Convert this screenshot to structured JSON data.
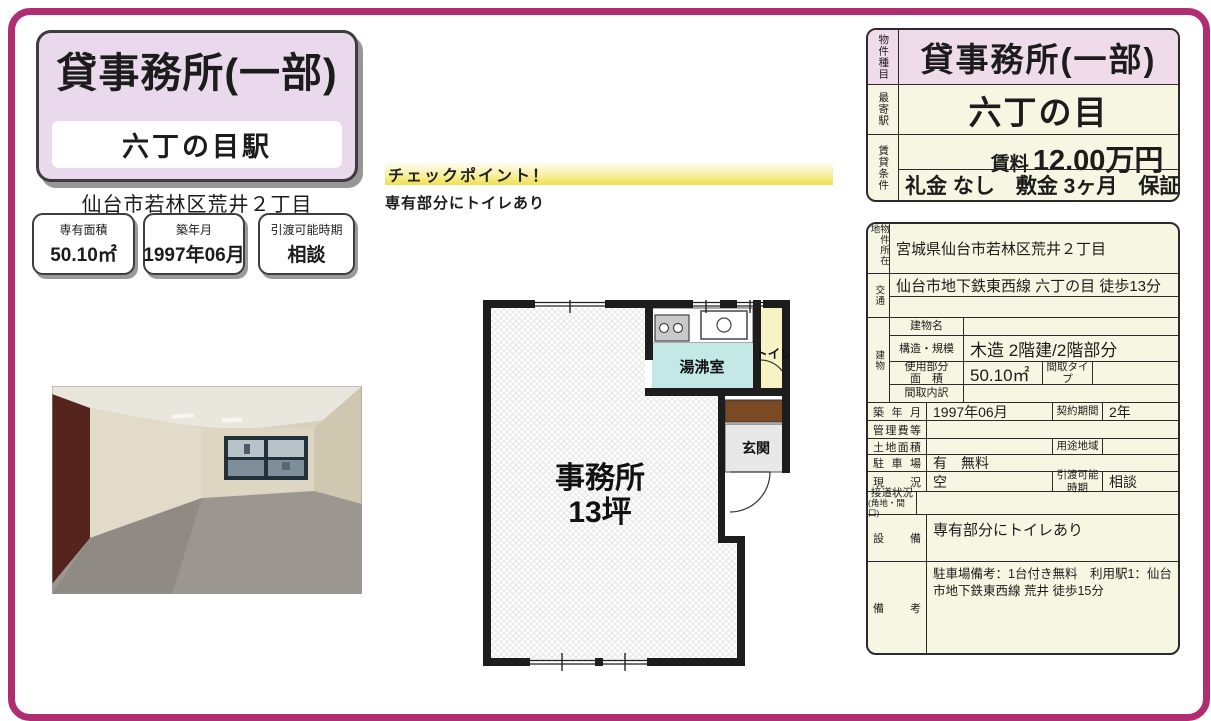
{
  "colors": {
    "frame": "#b02d72",
    "title_bg": "#ead9ec",
    "table_bg": "#f6f6e2",
    "pink_row": "#f0dbea",
    "checkpoint_yellow": "#efe14e",
    "kitchen_teal": "#c3e8e5",
    "toilet_yellow": "#f8f3c5",
    "entrance_brown": "#7a4a24"
  },
  "header": {
    "title": "貸事務所(一部)",
    "station": "六丁の目駅",
    "address": "仙台市若林区荒井２丁目"
  },
  "info_boxes": [
    {
      "label": "専有面積",
      "value": "50.10㎡"
    },
    {
      "label": "築年月",
      "value": "1997年06月"
    },
    {
      "label": "引渡可能時期",
      "value": "相談"
    }
  ],
  "checkpoint": {
    "title": "チェックポイント！",
    "text": "専有部分にトイレあり"
  },
  "floorplan": {
    "office": "事務所",
    "office_size": "13坪",
    "kitchen": "湯沸室",
    "toilet": "トイレ",
    "entrance": "玄関"
  },
  "summary_table": {
    "type_label": "物件種目",
    "type": "貸事務所(一部)",
    "station_label": "最寄駅",
    "station": "六丁の目",
    "terms_label": "賃貸条件",
    "rent_label": "賃料",
    "rent": "12.00万円",
    "fees": "礼金 なし　敷金 3ヶ月　保証金 なし"
  },
  "detail_table": {
    "location_label": "物件所在地",
    "location": "宮城県仙台市若林区荒井２丁目",
    "access_label": "交通",
    "access": "仙台市地下鉄東西線 六丁の目 徒歩13分",
    "access2": "",
    "building_label": "建物",
    "building_name_label": "建物名",
    "building_name": "",
    "structure_label": "構造・規模",
    "structure": "木造 2階建/2階部分",
    "area_label1": "使用部分",
    "area_label2": "面　積",
    "area": "50.10㎡",
    "layout_type_label": "間取タイプ",
    "layout_type": "",
    "layout_detail_label": "間取内訳",
    "layout_detail": "",
    "built_label": "築年月",
    "built": "1997年06月",
    "contract_label": "契約期間",
    "contract": "2年",
    "mgmt_label": "管理費等",
    "mgmt": "",
    "land_label": "土地面積",
    "land": "",
    "zoning_label": "用途地域",
    "zoning": "",
    "parking_label": "駐車場",
    "parking": "有　無料",
    "status_label": "現　況",
    "status": "空",
    "handover_label1": "引渡可能",
    "handover_label2": "時期",
    "handover": "相談",
    "road_label1": "接道状況",
    "road_label2": "(角地・間口)",
    "road": "",
    "equipment_label": "設　備",
    "equipment": "専有部分にトイレあり",
    "remarks_label": "備　考",
    "remarks": "駐車場備考：1台付き無料　利用駅1：仙台市地下鉄東西線 荒井 徒歩15分"
  }
}
